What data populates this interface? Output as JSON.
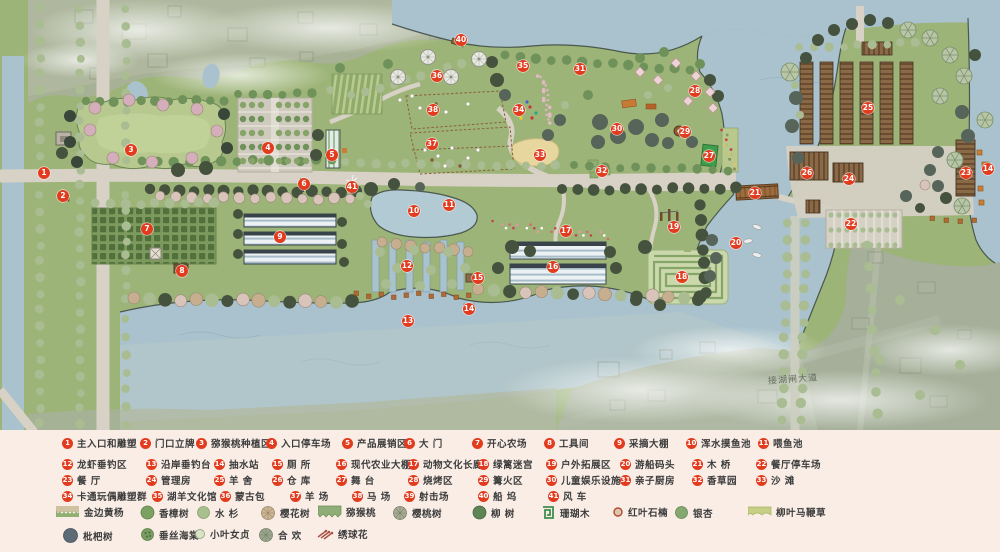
{
  "road_label": "接湖闸大道",
  "colors": {
    "water": "#a9c2cd",
    "land": "#9db478",
    "road": "#d8d2c6",
    "context": "#a8b198",
    "marker": "#e23b1e",
    "legend_bg": "#f9ede6"
  },
  "markers": [
    {
      "n": "1",
      "x": 44,
      "y": 173
    },
    {
      "n": "2",
      "x": 63,
      "y": 196
    },
    {
      "n": "3",
      "x": 131,
      "y": 150
    },
    {
      "n": "4",
      "x": 268,
      "y": 148
    },
    {
      "n": "5",
      "x": 332,
      "y": 155
    },
    {
      "n": "6",
      "x": 304,
      "y": 184
    },
    {
      "n": "7",
      "x": 147,
      "y": 229
    },
    {
      "n": "8",
      "x": 182,
      "y": 271
    },
    {
      "n": "9",
      "x": 280,
      "y": 237
    },
    {
      "n": "10",
      "x": 414,
      "y": 211
    },
    {
      "n": "11",
      "x": 449,
      "y": 205
    },
    {
      "n": "12",
      "x": 407,
      "y": 266
    },
    {
      "n": "13",
      "x": 408,
      "y": 321
    },
    {
      "n": "14",
      "x": 469,
      "y": 309
    },
    {
      "n": "14",
      "x": 988,
      "y": 169
    },
    {
      "n": "15",
      "x": 478,
      "y": 278
    },
    {
      "n": "16",
      "x": 553,
      "y": 267
    },
    {
      "n": "17",
      "x": 566,
      "y": 231
    },
    {
      "n": "18",
      "x": 682,
      "y": 277
    },
    {
      "n": "19",
      "x": 674,
      "y": 227
    },
    {
      "n": "20",
      "x": 736,
      "y": 243
    },
    {
      "n": "21",
      "x": 755,
      "y": 193
    },
    {
      "n": "22",
      "x": 851,
      "y": 224
    },
    {
      "n": "23",
      "x": 966,
      "y": 173
    },
    {
      "n": "24",
      "x": 849,
      "y": 179
    },
    {
      "n": "25",
      "x": 868,
      "y": 108
    },
    {
      "n": "26",
      "x": 807,
      "y": 173
    },
    {
      "n": "27",
      "x": 709,
      "y": 156
    },
    {
      "n": "28",
      "x": 695,
      "y": 91
    },
    {
      "n": "29",
      "x": 685,
      "y": 132
    },
    {
      "n": "30",
      "x": 617,
      "y": 129
    },
    {
      "n": "31",
      "x": 580,
      "y": 69
    },
    {
      "n": "32",
      "x": 602,
      "y": 171
    },
    {
      "n": "33",
      "x": 540,
      "y": 155
    },
    {
      "n": "34",
      "x": 519,
      "y": 110
    },
    {
      "n": "35",
      "x": 523,
      "y": 66
    },
    {
      "n": "36",
      "x": 437,
      "y": 76
    },
    {
      "n": "37",
      "x": 432,
      "y": 144
    },
    {
      "n": "38",
      "x": 433,
      "y": 110
    },
    {
      "n": "40",
      "x": 461,
      "y": 40
    },
    {
      "n": "41",
      "x": 352,
      "y": 187
    }
  ],
  "legend": {
    "items": [
      {
        "n": "1",
        "label": "主入口和雕塑",
        "x": 62,
        "y": 436
      },
      {
        "n": "2",
        "label": "门口立牌",
        "x": 140,
        "y": 436
      },
      {
        "n": "3",
        "label": "猕猴桃种植区",
        "x": 196,
        "y": 436
      },
      {
        "n": "4",
        "label": "入口停车场",
        "x": 266,
        "y": 436
      },
      {
        "n": "5",
        "label": "产品展销区",
        "x": 342,
        "y": 436
      },
      {
        "n": "6",
        "label": "大 门",
        "x": 404,
        "y": 436
      },
      {
        "n": "7",
        "label": "开心农场",
        "x": 472,
        "y": 436
      },
      {
        "n": "8",
        "label": "工具间",
        "x": 544,
        "y": 436
      },
      {
        "n": "9",
        "label": "采摘大棚",
        "x": 614,
        "y": 436
      },
      {
        "n": "10",
        "label": "浑水摸鱼池",
        "x": 686,
        "y": 436
      },
      {
        "n": "11",
        "label": "喂鱼池",
        "x": 758,
        "y": 436
      },
      {
        "n": "12",
        "label": "龙虾垂钓区",
        "x": 62,
        "y": 457
      },
      {
        "n": "13",
        "label": "沿岸垂钓台",
        "x": 146,
        "y": 457
      },
      {
        "n": "14",
        "label": "抽水站",
        "x": 214,
        "y": 457
      },
      {
        "n": "15",
        "label": "厕 所",
        "x": 272,
        "y": 457
      },
      {
        "n": "16",
        "label": "现代农业大棚",
        "x": 336,
        "y": 457
      },
      {
        "n": "17",
        "label": "动物文化长廊",
        "x": 408,
        "y": 457
      },
      {
        "n": "18",
        "label": "绿篱迷宫",
        "x": 478,
        "y": 457
      },
      {
        "n": "19",
        "label": "户外拓展区",
        "x": 546,
        "y": 457
      },
      {
        "n": "20",
        "label": "游船码头",
        "x": 620,
        "y": 457
      },
      {
        "n": "21",
        "label": "木 桥",
        "x": 692,
        "y": 457
      },
      {
        "n": "22",
        "label": "餐厅停车场",
        "x": 756,
        "y": 457
      },
      {
        "n": "23",
        "label": "餐 厅",
        "x": 62,
        "y": 473
      },
      {
        "n": "24",
        "label": "管理房",
        "x": 146,
        "y": 473
      },
      {
        "n": "25",
        "label": "羊 舍",
        "x": 214,
        "y": 473
      },
      {
        "n": "26",
        "label": "仓 库",
        "x": 272,
        "y": 473
      },
      {
        "n": "27",
        "label": "舞 台",
        "x": 336,
        "y": 473
      },
      {
        "n": "28",
        "label": "烧烤区",
        "x": 408,
        "y": 473
      },
      {
        "n": "29",
        "label": "篝火区",
        "x": 478,
        "y": 473
      },
      {
        "n": "30",
        "label": "儿童娱乐设施",
        "x": 546,
        "y": 473
      },
      {
        "n": "31",
        "label": "亲子厨房",
        "x": 620,
        "y": 473
      },
      {
        "n": "32",
        "label": "香草园",
        "x": 692,
        "y": 473
      },
      {
        "n": "33",
        "label": "沙 滩",
        "x": 756,
        "y": 473
      },
      {
        "n": "34",
        "label": "卡通玩偶雕塑群",
        "x": 62,
        "y": 489
      },
      {
        "n": "35",
        "label": "湖羊文化馆",
        "x": 152,
        "y": 489
      },
      {
        "n": "36",
        "label": "蒙古包",
        "x": 220,
        "y": 489
      },
      {
        "n": "37",
        "label": "羊 场",
        "x": 290,
        "y": 489
      },
      {
        "n": "38",
        "label": "马 场",
        "x": 352,
        "y": 489
      },
      {
        "n": "39",
        "label": "射击场",
        "x": 404,
        "y": 489
      },
      {
        "n": "40",
        "label": "船 坞",
        "x": 478,
        "y": 489
      },
      {
        "n": "41",
        "label": "风 车",
        "x": 548,
        "y": 489
      }
    ],
    "plants": [
      {
        "type": "hedge-band",
        "label": "金边黄杨",
        "x": 56,
        "y": 505
      },
      {
        "type": "camphor",
        "label": "香樟树",
        "x": 140,
        "y": 505
      },
      {
        "type": "metasequoia",
        "label": "水 杉",
        "x": 196,
        "y": 505
      },
      {
        "type": "cherry-blossom",
        "label": "樱花树",
        "x": 260,
        "y": 505
      },
      {
        "type": "kiwi-band",
        "label": "猕猴桃",
        "x": 318,
        "y": 505
      },
      {
        "type": "cherry",
        "label": "樱桃树",
        "x": 392,
        "y": 505
      },
      {
        "type": "willow-tree",
        "label": "柳 树",
        "x": 472,
        "y": 505
      },
      {
        "type": "coral-wood",
        "label": "珊瑚木",
        "x": 540,
        "y": 505
      },
      {
        "type": "photinia",
        "label": "红叶石楠",
        "x": 612,
        "y": 505
      },
      {
        "type": "ginkgo",
        "label": "银杏",
        "x": 674,
        "y": 505
      },
      {
        "type": "verbena-band",
        "label": "柳叶马鞭草",
        "x": 748,
        "y": 505
      },
      {
        "type": "loquat",
        "label": "枇杷树",
        "x": 62,
        "y": 527
      },
      {
        "type": "crabapple",
        "label": "垂丝海棠",
        "x": 140,
        "y": 527
      },
      {
        "type": "privet",
        "label": "小叶女贞",
        "x": 194,
        "y": 527
      },
      {
        "type": "albizia",
        "label": "合 欢",
        "x": 258,
        "y": 527
      },
      {
        "type": "hydrangea",
        "label": "绣球花",
        "x": 316,
        "y": 527
      }
    ]
  }
}
